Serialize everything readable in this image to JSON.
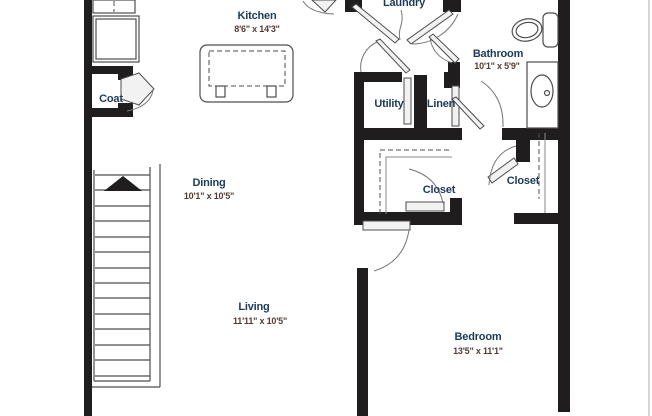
{
  "palette": {
    "bg": "#ffffff",
    "wall": "#1f1d1d",
    "line": "#4d4d4d",
    "pageline": "#c9c9c9",
    "room_label": "#1c3b5a",
    "dims_label": "#553a31"
  },
  "rooms": {
    "laundry": {
      "name": "Laundry",
      "dims": ""
    },
    "kitchen": {
      "name": "Kitchen",
      "dims": "8'6\" x 14'3\""
    },
    "coat": {
      "name": "Coat",
      "dims": ""
    },
    "bathroom": {
      "name": "Bathroom",
      "dims": "10'1\" x 5'9\""
    },
    "utility": {
      "name": "Utility",
      "dims": ""
    },
    "linen": {
      "name": "Linen",
      "dims": ""
    },
    "dining": {
      "name": "Dining",
      "dims": "10'1\" x 10'5\""
    },
    "closet_left": {
      "name": "Closet",
      "dims": ""
    },
    "closet_right": {
      "name": "Closet",
      "dims": ""
    },
    "living": {
      "name": "Living",
      "dims": "11'11\" x 10'5\""
    },
    "bedroom": {
      "name": "Bedroom",
      "dims": "13'5\" x 11'1\""
    }
  }
}
